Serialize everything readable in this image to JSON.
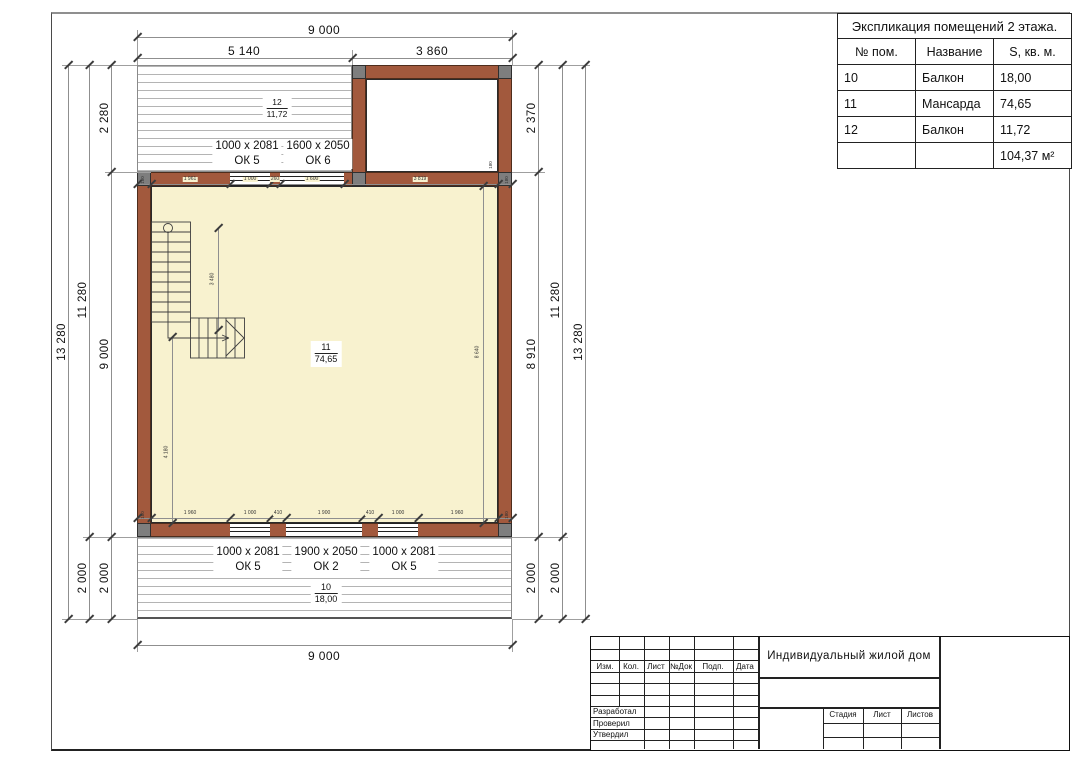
{
  "colors": {
    "wall": "#a2593d",
    "floor": "#f8f2cf",
    "corner": "#7e7e7e"
  },
  "explication": {
    "title": "Экспликация помещений 2 этажа.",
    "headers": [
      "№ пом.",
      "Название",
      "S, кв. м."
    ],
    "rows": [
      [
        "10",
        "Балкон",
        "18,00"
      ],
      [
        "11",
        "Мансарда",
        "74,65"
      ],
      [
        "12",
        "Балкон",
        "11,72"
      ],
      [
        "",
        "",
        "104,37 м²"
      ]
    ]
  },
  "stamp": {
    "project": "Индивидуальный жилой дом",
    "header_cols": [
      "Изм.",
      "Кол.",
      "Лист",
      "№Док",
      "Подп.",
      "Дата"
    ],
    "sign_rows": [
      "Разработал",
      "Проверил",
      "Утвердил"
    ],
    "stage_cols": [
      "Стадия",
      "Лист",
      "Листов"
    ]
  },
  "plan": {
    "rooms": {
      "balcony_top": {
        "num": "12",
        "area": "11,72"
      },
      "mansarda": {
        "num": "11",
        "area": "74,65"
      },
      "balcony_bottom": {
        "num": "10",
        "area": "18,00"
      }
    },
    "windows_top": [
      {
        "size": "1000 x 2081",
        "mark": "ОК 5"
      },
      {
        "size": "1600 x 2050",
        "mark": "ОК 6"
      }
    ],
    "windows_bottom": [
      {
        "size": "1000 x 2081",
        "mark": "ОК 5"
      },
      {
        "size": "1900 x 2050",
        "mark": "ОК 2"
      },
      {
        "size": "1000 x 2081",
        "mark": "ОК 5"
      }
    ],
    "dims": {
      "top_total": "9 000",
      "top_left": "5 140",
      "top_right": "3 860",
      "bottom_total": "9 000",
      "left": {
        "outer": "13 280",
        "mid_upper": "11 280",
        "mid_lower": "2 000",
        "inner_top": "2 280",
        "inner_mid": "9 000",
        "inner_bottom": "2 000"
      },
      "right": {
        "inner_top": "2 370",
        "inner_mid": "8 910",
        "inner_bottom": "2 000",
        "mid_upper": "11 280",
        "mid_lower": "2 000",
        "outer": "13 280"
      },
      "chain_top": [
        "180",
        "1 961",
        "1 000",
        "260",
        "1 600",
        "3 819",
        "180"
      ],
      "chain_bottom": [
        "180",
        "1 960",
        "1 000",
        "410",
        "1 900",
        "410",
        "1 000",
        "1 960",
        "180"
      ],
      "stair": "3 480",
      "left_inner_v": "4 180",
      "right_inner_v": "8 640",
      "wall": "180"
    }
  }
}
